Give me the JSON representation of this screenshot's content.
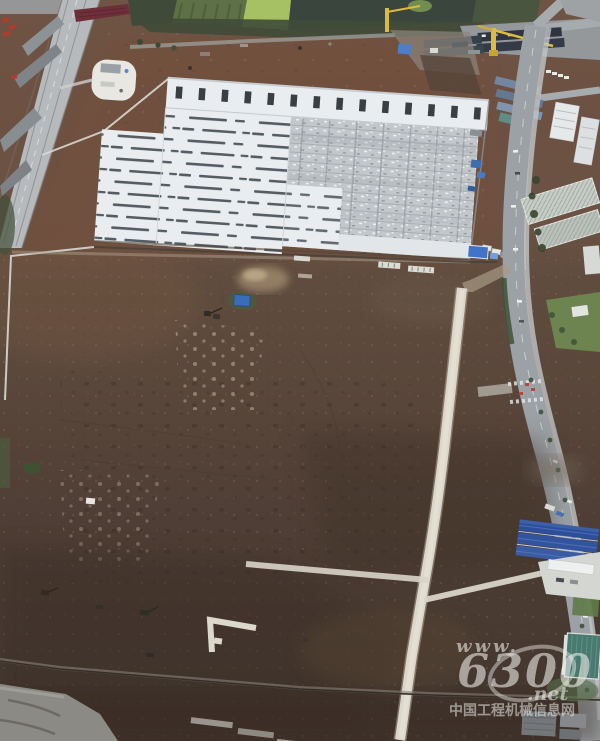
{
  "meta": {
    "type": "aerial-photograph",
    "subject": "drone view of a large construction site: partially built white warehouse with exposed steel framing, brown earthworks field with concrete haul roads, elevated highway at left, city road and buildings at right",
    "size": "600x741"
  },
  "watermark": {
    "url_prefix": "www.",
    "logo_number": "6300",
    "domain_suffix": ".net",
    "site_name": "中国工程机械信息网",
    "color": "#eceae6"
  },
  "palette": {
    "dirt_north": "#6f5141",
    "dirt_mid": "#5e4a3c",
    "dirt_south": "#4c3c33",
    "mud_gray": "#8b8a84",
    "roof_white": "#e9edf0",
    "roof_dash": "#39434b",
    "steel_frame": "#c2c7cb",
    "concrete_road": "#dcd7cb",
    "asphalt_road": "#9ba1a5",
    "highway_gray": "#b6babd",
    "water_dark": "#3a453e",
    "pond_green": "#a6c163",
    "crop_rows": "#5e7045",
    "tree_green": "#41503a",
    "crane_yellow": "#e0bc3e",
    "blue_roof": "#2c4e9c",
    "gate_blue": "#3f74c8",
    "teal_glass": "#49796f",
    "machine_red": "#b23a2e",
    "watermark": "#eceae6"
  }
}
